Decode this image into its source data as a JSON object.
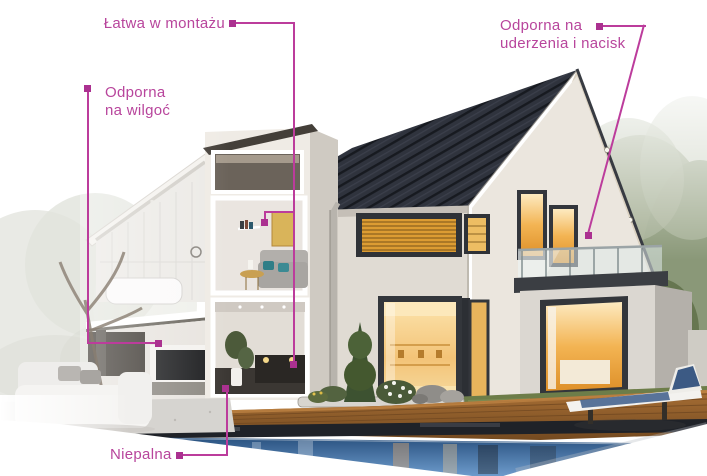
{
  "palette": {
    "accent_line": "#bc3c9c",
    "accent_marker": "#ab3190",
    "accent_text": "#b8459c",
    "roof": "#2f333d",
    "wall_cream": "#ebe6de",
    "window_glow": "#f0b454",
    "pool_water": "#4a77ab",
    "deck_wood": "#94602e",
    "grass": "#68774a",
    "foliage": "#8d9a7c"
  },
  "annotations": {
    "items": [
      {
        "id": "easy-install",
        "label": "Łatwa w montażu"
      },
      {
        "id": "moisture-resistant",
        "label": "Odporna\nna wilgoć"
      },
      {
        "id": "impact-resistant",
        "label": "Odporna na\nuderzenia i nacisk"
      },
      {
        "id": "non-flammable",
        "label": "Niepalna"
      }
    ]
  },
  "scene": {
    "elements": [
      "cutaway-house",
      "family-house",
      "tiled-roof",
      "balcony",
      "swimming-pool",
      "wooden-deck",
      "sun-lounger",
      "garden",
      "trees"
    ]
  }
}
